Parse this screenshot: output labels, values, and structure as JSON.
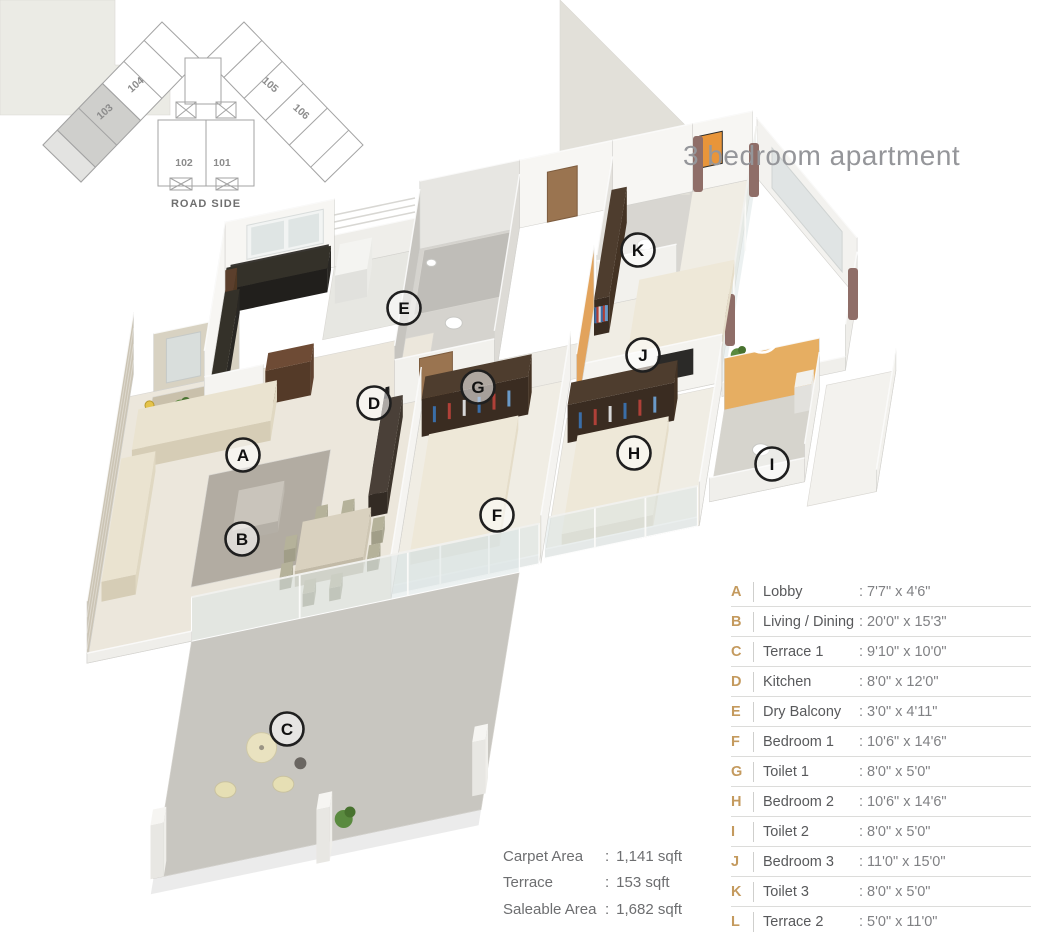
{
  "title": "3 bedroom apartment",
  "keyplan": {
    "road_label": "ROAD SIDE",
    "units": [
      "103",
      "104",
      "105",
      "106",
      "102",
      "101"
    ],
    "highlighted_unit": "103"
  },
  "floorplan": {
    "markers": [
      {
        "label": "A",
        "x": 243,
        "y": 455
      },
      {
        "label": "B",
        "x": 242,
        "y": 539
      },
      {
        "label": "C",
        "x": 287,
        "y": 729
      },
      {
        "label": "D",
        "x": 374,
        "y": 403
      },
      {
        "label": "E",
        "x": 404,
        "y": 308
      },
      {
        "label": "F",
        "x": 497,
        "y": 515
      },
      {
        "label": "G",
        "x": 478,
        "y": 387
      },
      {
        "label": "H",
        "x": 634,
        "y": 453
      },
      {
        "label": "I",
        "x": 772,
        "y": 464
      },
      {
        "label": "J",
        "x": 643,
        "y": 355
      },
      {
        "label": "K",
        "x": 638,
        "y": 250
      },
      {
        "label": "L",
        "x": 762,
        "y": 336
      }
    ]
  },
  "legend": {
    "size_prefix": ": ",
    "rows": [
      {
        "key": "A",
        "name": "Lobby",
        "size": "7'7\" x 4'6\""
      },
      {
        "key": "B",
        "name": "Living / Dining",
        "size": "20'0\" x 15'3\""
      },
      {
        "key": "C",
        "name": "Terrace 1",
        "size": "9'10\" x 10'0\""
      },
      {
        "key": "D",
        "name": "Kitchen",
        "size": "8'0\" x 12'0\""
      },
      {
        "key": "E",
        "name": "Dry Balcony",
        "size": "3'0\" x 4'11\""
      },
      {
        "key": "F",
        "name": "Bedroom 1",
        "size": "10'6\" x 14'6\""
      },
      {
        "key": "G",
        "name": "Toilet 1",
        "size": "8'0\" x 5'0\""
      },
      {
        "key": "H",
        "name": "Bedroom 2",
        "size": "10'6\" x 14'6\""
      },
      {
        "key": "I",
        "name": "Toilet 2",
        "size": "8'0\" x 5'0\""
      },
      {
        "key": "J",
        "name": "Bedroom 3",
        "size": "11'0\" x 15'0\""
      },
      {
        "key": "K",
        "name": "Toilet 3",
        "size": "8'0\" x 5'0\""
      },
      {
        "key": "L",
        "name": "Terrace 2",
        "size": "5'0\" x 11'0\""
      }
    ]
  },
  "areas": {
    "separator": ":",
    "rows": [
      {
        "label": "Carpet Area",
        "value": "1,141 sqft"
      },
      {
        "label": "Terrace",
        "value": "153 sqft"
      },
      {
        "label": "Saleable Area",
        "value": "1,682 sqft"
      }
    ]
  },
  "colors": {
    "legend_letter": "#c49a5e",
    "title_gray": "#95969a",
    "orange_wall": "#e2a35c",
    "stone_wall": "#cbc4b4"
  }
}
